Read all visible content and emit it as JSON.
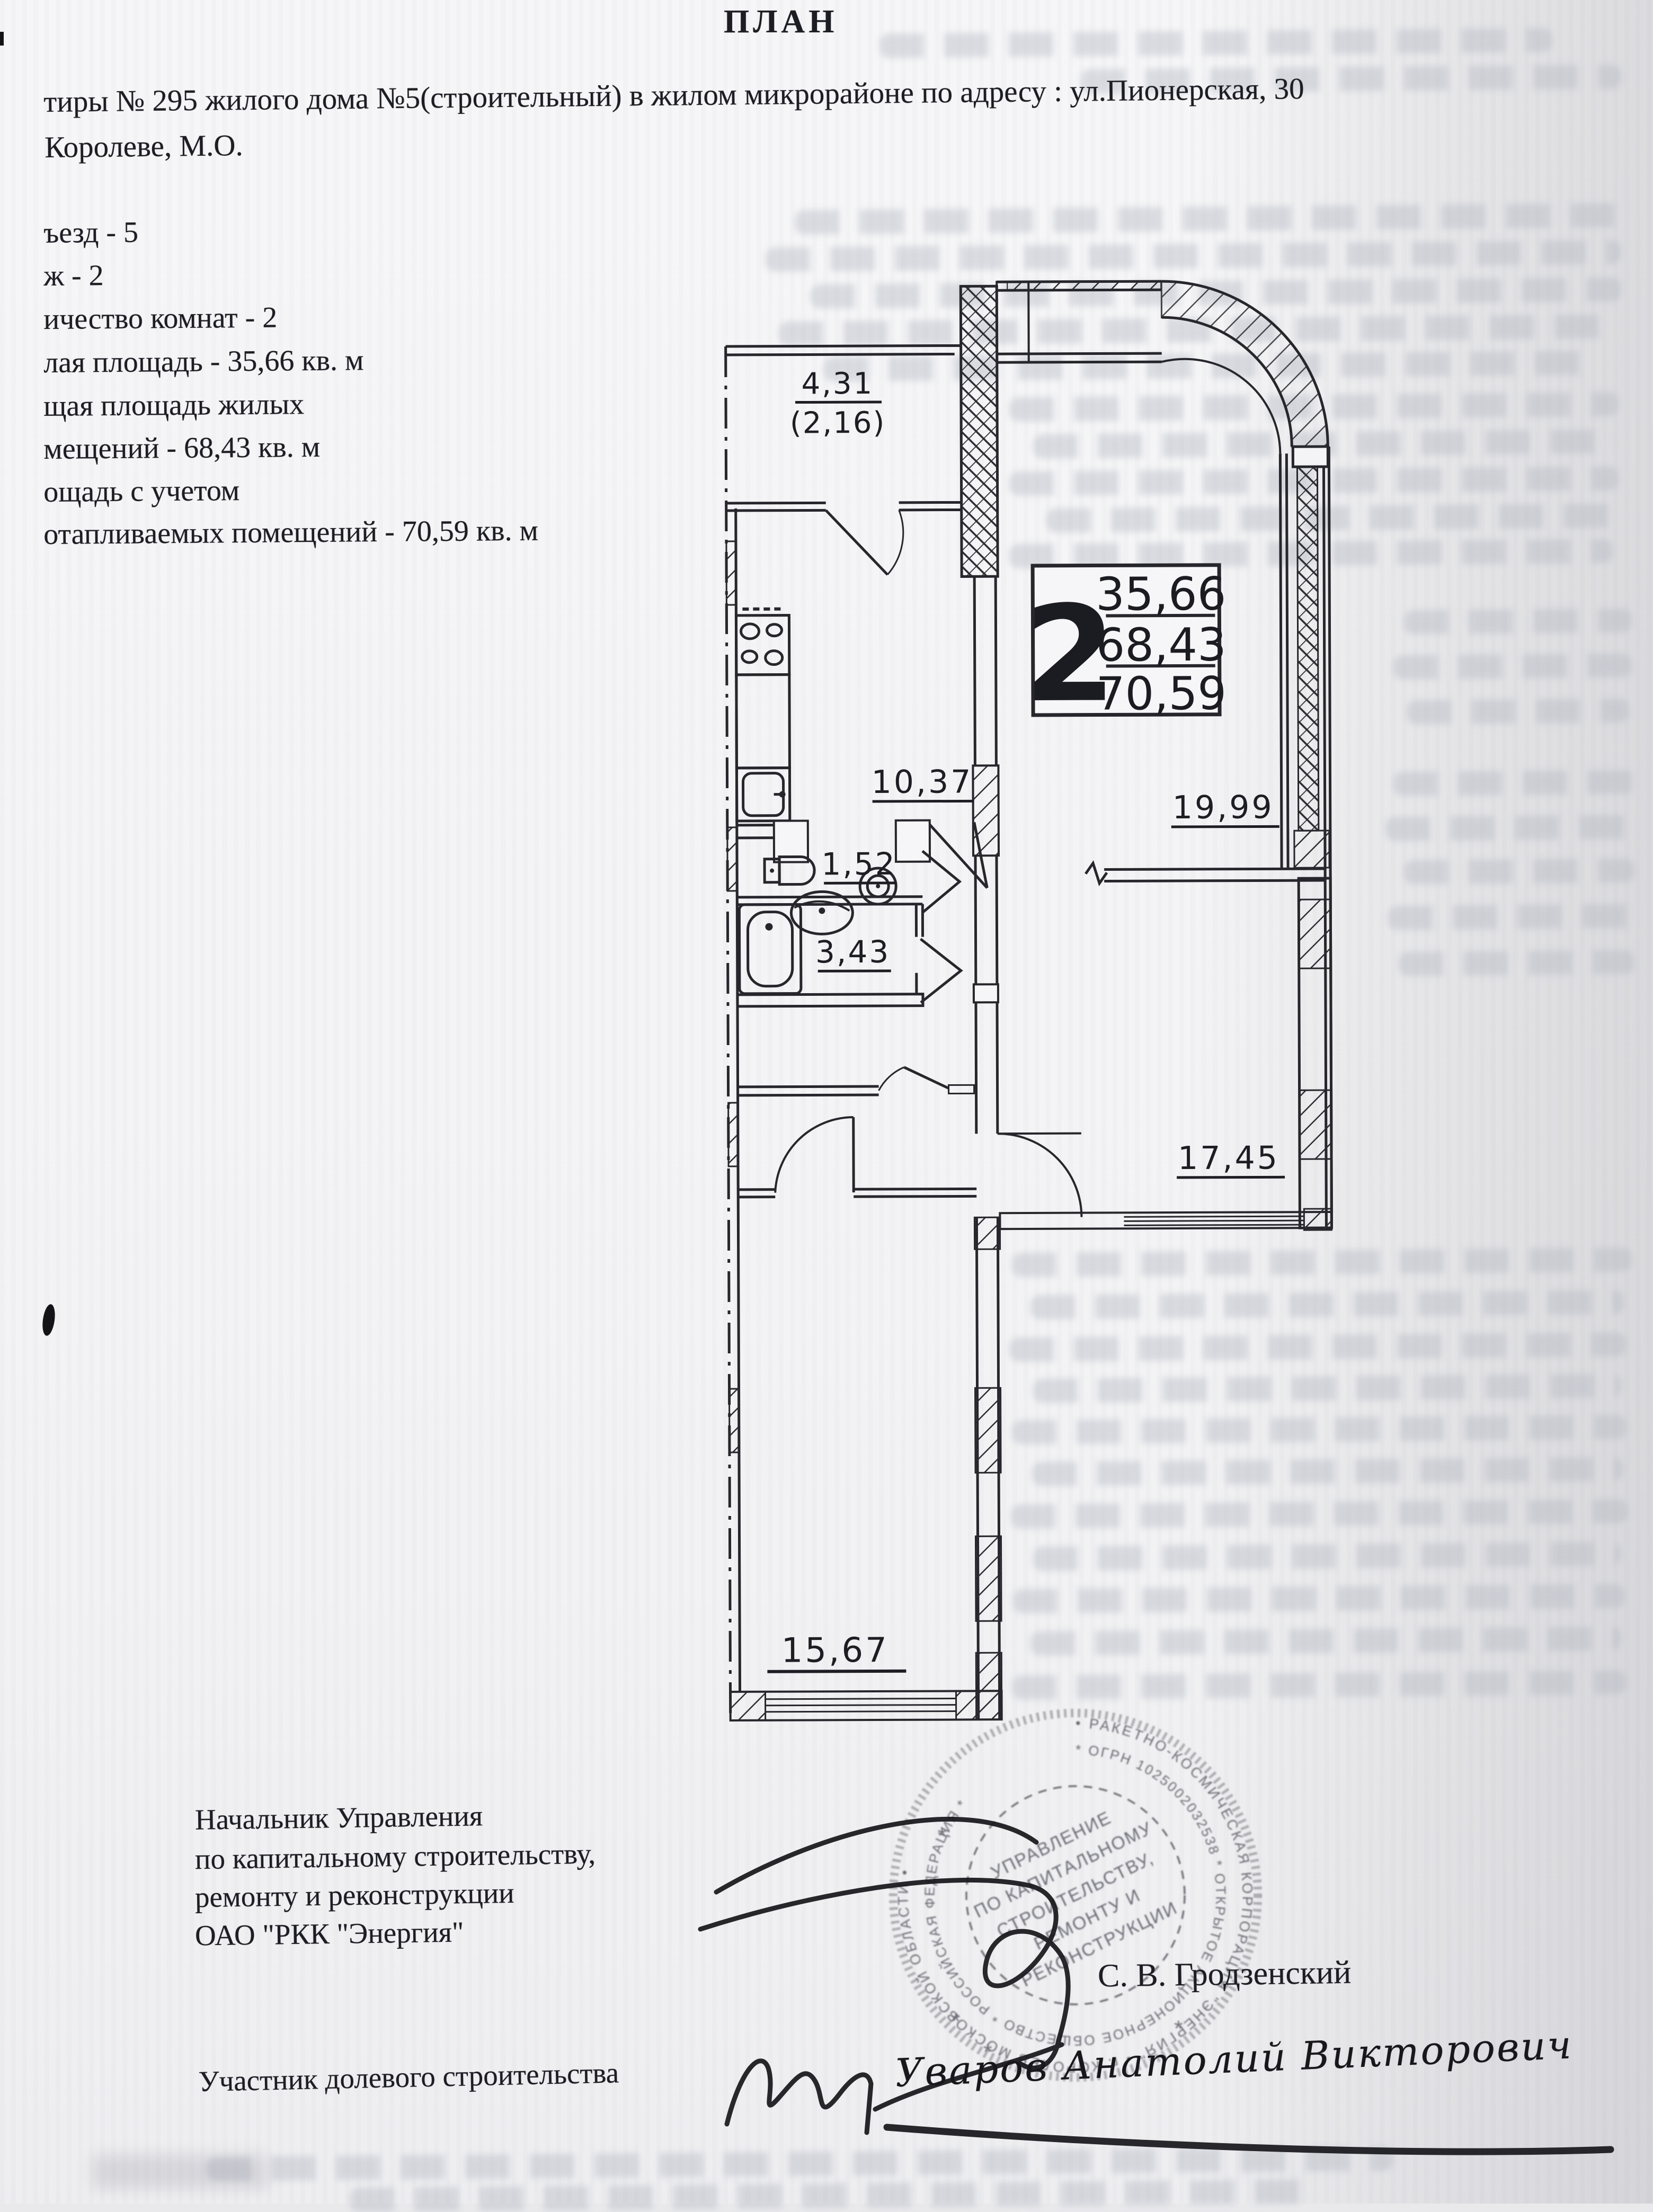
{
  "title": "ПЛАН",
  "header": {
    "line1": "тиры № 295 жилого дома №5(строительный) в жилом микрорайоне по адресу : ул.Пионерская, 30",
    "line2": "Королеве, М.О."
  },
  "details": {
    "lines": [
      "ъезд - 5",
      "ж - 2",
      "ичество комнат - 2",
      "лая площадь - 35,66 кв. м",
      "щая площадь жилых",
      "мещений - 68,43 кв. м",
      "ощадь с учетом",
      "отапливаемых помещений - 70,59 кв. м"
    ]
  },
  "plan": {
    "rooms": [
      {
        "name": "balcony",
        "area": "4,31",
        "area_reduced": "(2,16)"
      },
      {
        "name": "kitchen",
        "area": "10,37"
      },
      {
        "name": "living-room",
        "area": "19,99"
      },
      {
        "name": "wc",
        "area": "1,52"
      },
      {
        "name": "bathroom",
        "area": "3,43"
      },
      {
        "name": "room-right",
        "area": "17,45"
      },
      {
        "name": "room-left",
        "area": "15,67"
      }
    ],
    "info_box": {
      "rooms_count": "2",
      "living_area": "35,66",
      "total_area": "68,43",
      "heated_area": "70,59"
    }
  },
  "stamp": {
    "outer_ring": "• РАКЕТНО-КОСМИЧЕСКАЯ КОРПОРАЦИЯ \"ЭНЕРГИЯ\" • г. КОРОЛЕВ МОСКОВСКОЙ ОБЛАСТИ •",
    "middle_ring": "* ОГРН 1025002032538 * ОТКРЫТОЕ АКЦИОНЕРНОЕ ОБЩЕСТВО * РОССИЙСКАЯ ФЕДЕРАЦИЯ *",
    "center_lines": [
      "УПРАВЛЕНИЕ",
      "ПО КАПИТАЛЬНОМУ",
      "СТРОИТЕЛЬСТВУ,",
      "РЕМОНТУ И",
      "РЕКОНСТРУКЦИИ"
    ]
  },
  "signatures": {
    "official_title_lines": [
      "Начальник Управления",
      "по капитальному строительству,",
      "ремонту и реконструкции",
      "ОАО \"РКК \"Энергия\""
    ],
    "official_name": "С. В. Гродзенский",
    "participant_label": "Участник долевого строительства",
    "participant_name": "Уваров Анатолий Викторович"
  },
  "colors": {
    "ink": "#1d1d24",
    "plan_line": "#26262c",
    "stamp_ink": "#4d4d58",
    "paper": "#f4f4f6",
    "bleed": "#b4b8c2"
  }
}
